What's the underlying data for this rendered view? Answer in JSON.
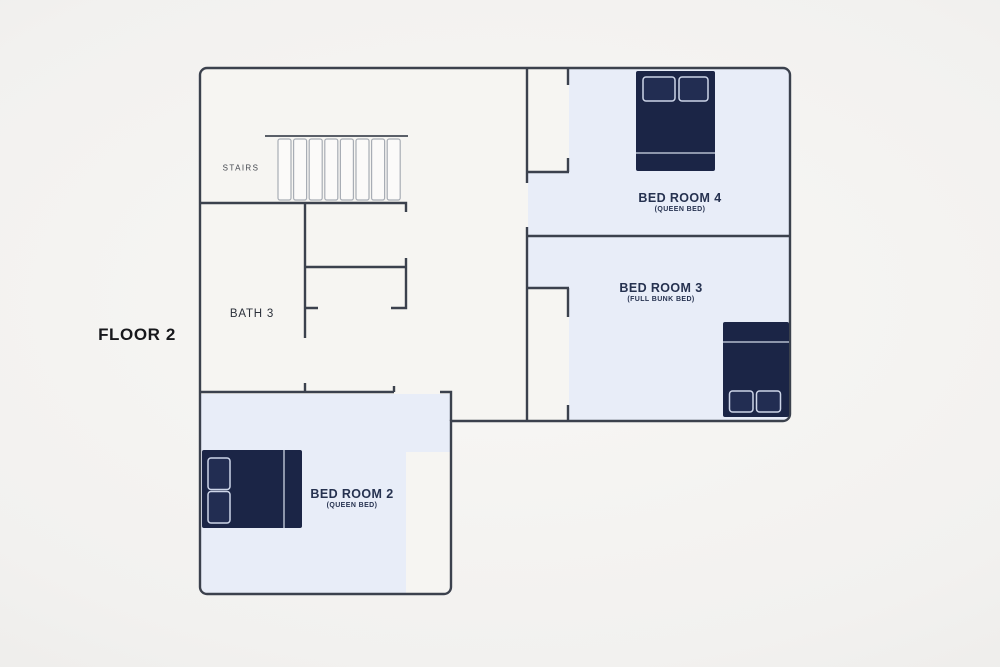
{
  "floor_label": "FLOOR 2",
  "rooms": {
    "stairs": {
      "label": "STAIRS"
    },
    "bath3": {
      "label": "BATH 3"
    },
    "bedroom2": {
      "label": "BED ROOM 2",
      "bed_type": "(QUEEN BED)"
    },
    "bedroom3": {
      "label": "BED ROOM 3",
      "bed_type": "(FULL BUNK BED)"
    },
    "bedroom4": {
      "label": "BED ROOM 4",
      "bed_type": "(QUEEN BED)"
    }
  },
  "colors": {
    "background": "#f1f0ee",
    "hall_floor": "#f6f5f2",
    "bedroom_floor": "#e8edf8",
    "wall": "#3b414d",
    "bed": "#1b2546",
    "pillow_outline": "#cdd5e8",
    "blanket_line": "#8d96ab",
    "label_text": "#263250"
  }
}
